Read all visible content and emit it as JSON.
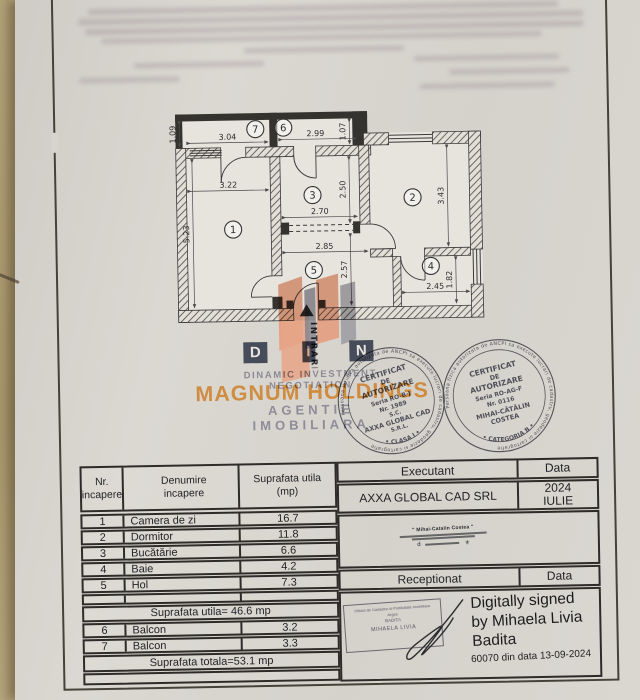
{
  "plan": {
    "rooms": [
      "1",
      "2",
      "3",
      "4",
      "5",
      "6",
      "7"
    ],
    "dims": [
      "1.09",
      "3.04",
      "2.99",
      "1.07",
      "3.22",
      "5.23",
      "2.70",
      "2.50",
      "3.43",
      "2.85",
      "2.57",
      "2.45",
      "1.82"
    ],
    "entrance": "INTRARE"
  },
  "watermark": {
    "logo_d": "D",
    "logo_i": "I",
    "logo_n": "N",
    "line1": "DINAMIC INVESTMENT NEGOTIATION",
    "line2": "MAGNUM HOLDINGS",
    "line3": "AGENTIE IMOBILIARA",
    "orange": "#cd7c20"
  },
  "stamps": {
    "left": {
      "ring": "Persoana juridica autorizata de ANCPI sa execute lucrari de cadastru, geodezie si cartografie",
      "l1": "CERTIFICAT",
      "l2": "DE",
      "l3": "AUTORIZARE",
      "l4": "Seria RO-B-J",
      "l5": "Nr. 1989",
      "l6": "S.C.",
      "l7": "AXXA GLOBAL CAD",
      "l8": "S.R.L.",
      "bottom": "•  CLASA I  •"
    },
    "right": {
      "ring": "Persoana fizica autorizata de ANCPI sa execute lucrari de cadastru, geodezie si cartografie",
      "l1": "CERTIFICAT",
      "l2": "DE",
      "l3": "AUTORIZARE",
      "l4": "Seria RO-AG-F",
      "l5": "Nr. 0116",
      "l6": "MIHAI-CĂTĂLIN",
      "l7": "COSTEA",
      "bottom": "•  CATEGORIA B  •"
    }
  },
  "table": {
    "header": {
      "c1a": "Nr.",
      "c1b": "incapere",
      "c2a": "Denumire",
      "c2b": "incapere",
      "c3a": "Suprafata utila",
      "c3b": "(mp)"
    },
    "rows": [
      {
        "nr": "1",
        "name": "Camera de zi",
        "area": "16.7"
      },
      {
        "nr": "2",
        "name": "Dormitor",
        "area": "11.8"
      },
      {
        "nr": "3",
        "name": "Bucătărie",
        "area": "6.6"
      },
      {
        "nr": "4",
        "name": "Baie",
        "area": "4.2"
      },
      {
        "nr": "5",
        "name": "Hol",
        "area": "7.3"
      }
    ],
    "subtotal": "Suprafata utila= 46.6 mp",
    "extra_rows": [
      {
        "nr": "6",
        "name": "Balcon",
        "area": "3.2"
      },
      {
        "nr": "7",
        "name": "Balcon",
        "area": "3.3"
      }
    ],
    "total": "Suprafata totala=53.1 mp"
  },
  "panel": {
    "executant_label": "Executant",
    "data_label": "Data",
    "executant_value": "AXXA GLOBAL CAD SRL",
    "date_line1": "2024",
    "date_line2": "IULIE",
    "signature_name": "\" Mihai-Catalin Costea \"",
    "receptionat_label": "Receptionat",
    "data_label2": "Data",
    "recep_stamp_line1": "Oficiul de Cadastru si Publicitate Imobiliara",
    "recep_stamp_line2": "Arges",
    "recep_stamp_line3": "BADITA",
    "recep_stamp_line4": "MIHAELA LIVIA",
    "digital1": "Digitally signed",
    "digital2": "by Mihaela Livia",
    "digital3": "Badita",
    "digital4": "60070 din data 13-09-2024"
  }
}
